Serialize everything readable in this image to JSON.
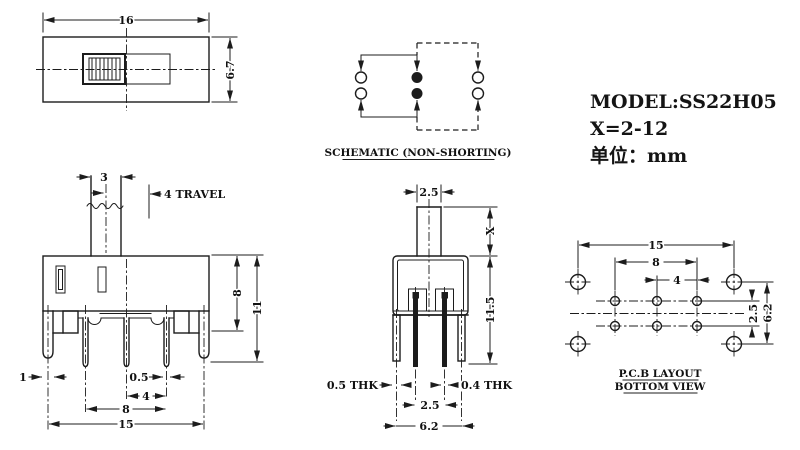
{
  "info": {
    "model": "MODEL:SS22H05",
    "travel_range": "X=2-12",
    "unit": "单位：mm"
  },
  "top_view": {
    "width": "16",
    "height": "6.7"
  },
  "schematic": {
    "caption": "SCHEMATIC (NON-SHORTING)"
  },
  "front_view": {
    "stem_width": "3",
    "travel": "4 TRAVEL",
    "body_height": "8",
    "total_height": "11",
    "tab_width": "1",
    "pin_width": "0.5",
    "pin_pitch": "4",
    "pin_span": "8",
    "mount_span": "15"
  },
  "side_view": {
    "stem_width": "2.5",
    "stem_height": "X",
    "body_height": "11.5",
    "left_thickness": "0.5 THK",
    "right_thickness": "0.4 THK",
    "pin_pitch": "2.5",
    "leg_span": "6.2"
  },
  "pcb_layout": {
    "corner_span": "15",
    "pin_span": "8",
    "pin_pitch": "4",
    "row_pitch": "2.5",
    "corner_row_pitch": "6.2",
    "caption_line1": "P.C.B LAYOUT",
    "caption_line2": "BOTTOM VIEW"
  },
  "colors": {
    "ink": "#1c1c1c",
    "background": "#ffffff"
  }
}
